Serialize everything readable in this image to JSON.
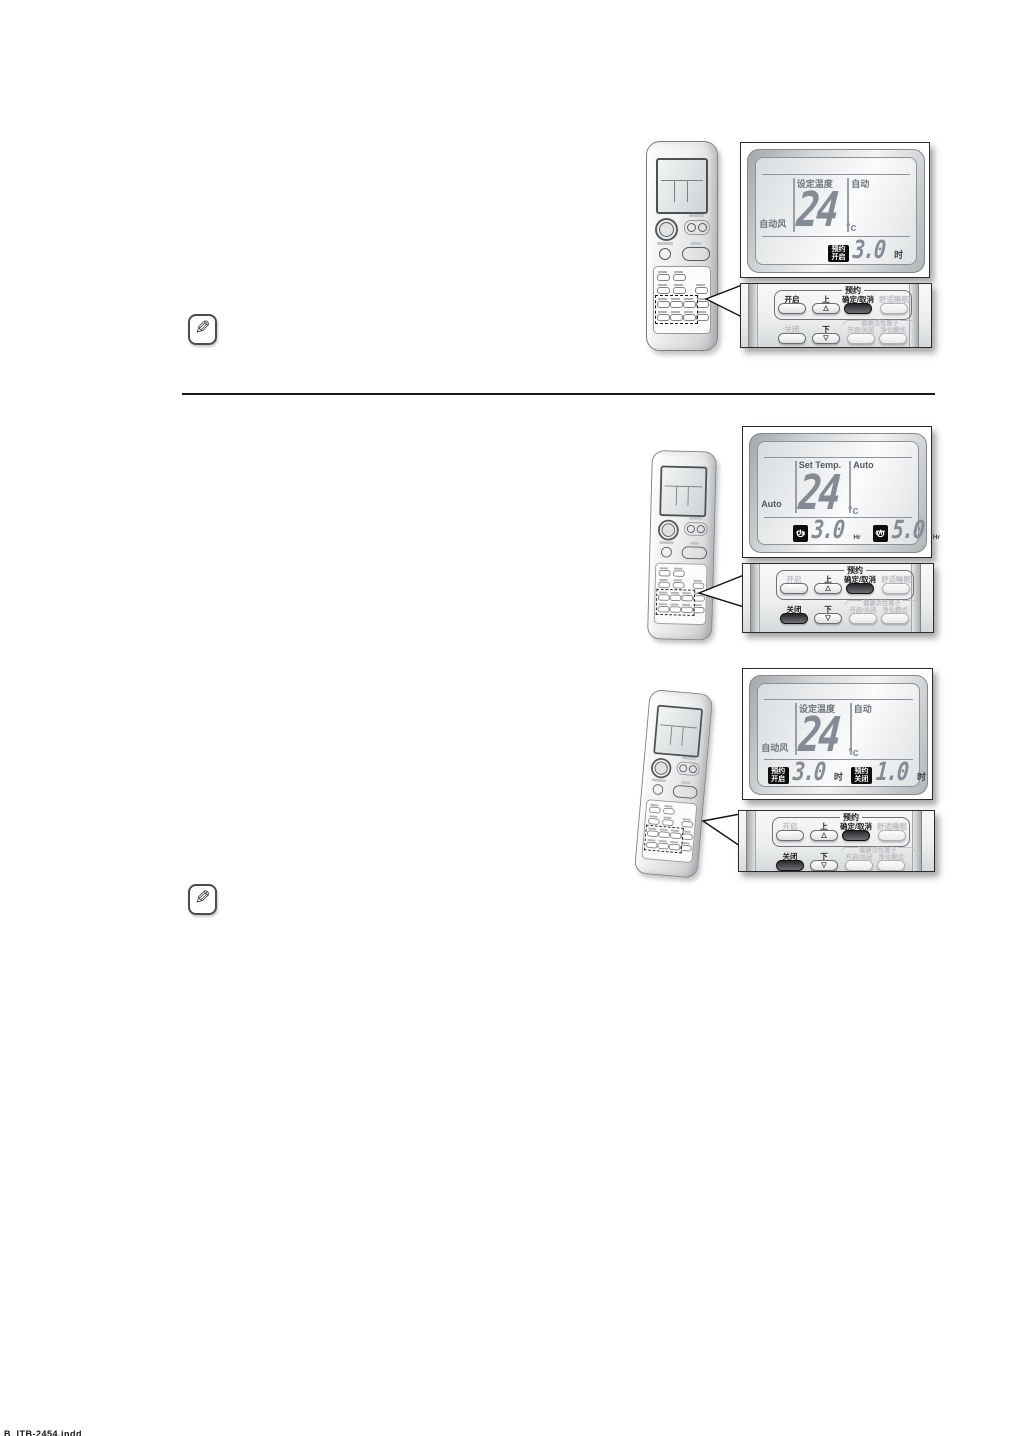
{
  "lcd_labels": {
    "set_temp_cn": "设定温度",
    "auto_cn": "自动",
    "auto_fan_cn": "自动风",
    "set_temp_en": "Set Temp.",
    "auto_en": "Auto",
    "temp_value": "24",
    "temp_unit": "°c",
    "hour_unit_cn": "时",
    "hour_unit_en": "Hr"
  },
  "display1": {
    "badge_on_line1": "预约",
    "badge_on_line2": "开启",
    "on_hours": "3.0"
  },
  "display2": {
    "badge_on": "On",
    "on_hours": "3.0",
    "badge_off": "Off",
    "off_hours": "5.0"
  },
  "display3": {
    "badge_on_line1": "预约",
    "badge_on_line2": "开启",
    "on_hours": "3.0",
    "badge_off_line1": "预约",
    "badge_off_line2": "关闭",
    "off_hours": "1.0"
  },
  "button_panel": {
    "group_label": "预约",
    "btn_on": "开启",
    "btn_up": "上",
    "btn_confirm": "确定/取消",
    "btn_sleep": "舒适睡眠",
    "btn_off": "关闭",
    "btn_down": "下",
    "ion_group_label": "健康活性离子",
    "btn_ion_onoff": "开启/关闭",
    "btn_ion_mode": "净化模式",
    "up_glyph": "△",
    "down_glyph": "▽"
  },
  "footer": {
    "text": "B_ITB-2454.indd"
  },
  "colors": {
    "badge_black": "#0c0c0c",
    "lcd_digit_grey": "#858b95",
    "callout_border": "#2b2b2b"
  }
}
